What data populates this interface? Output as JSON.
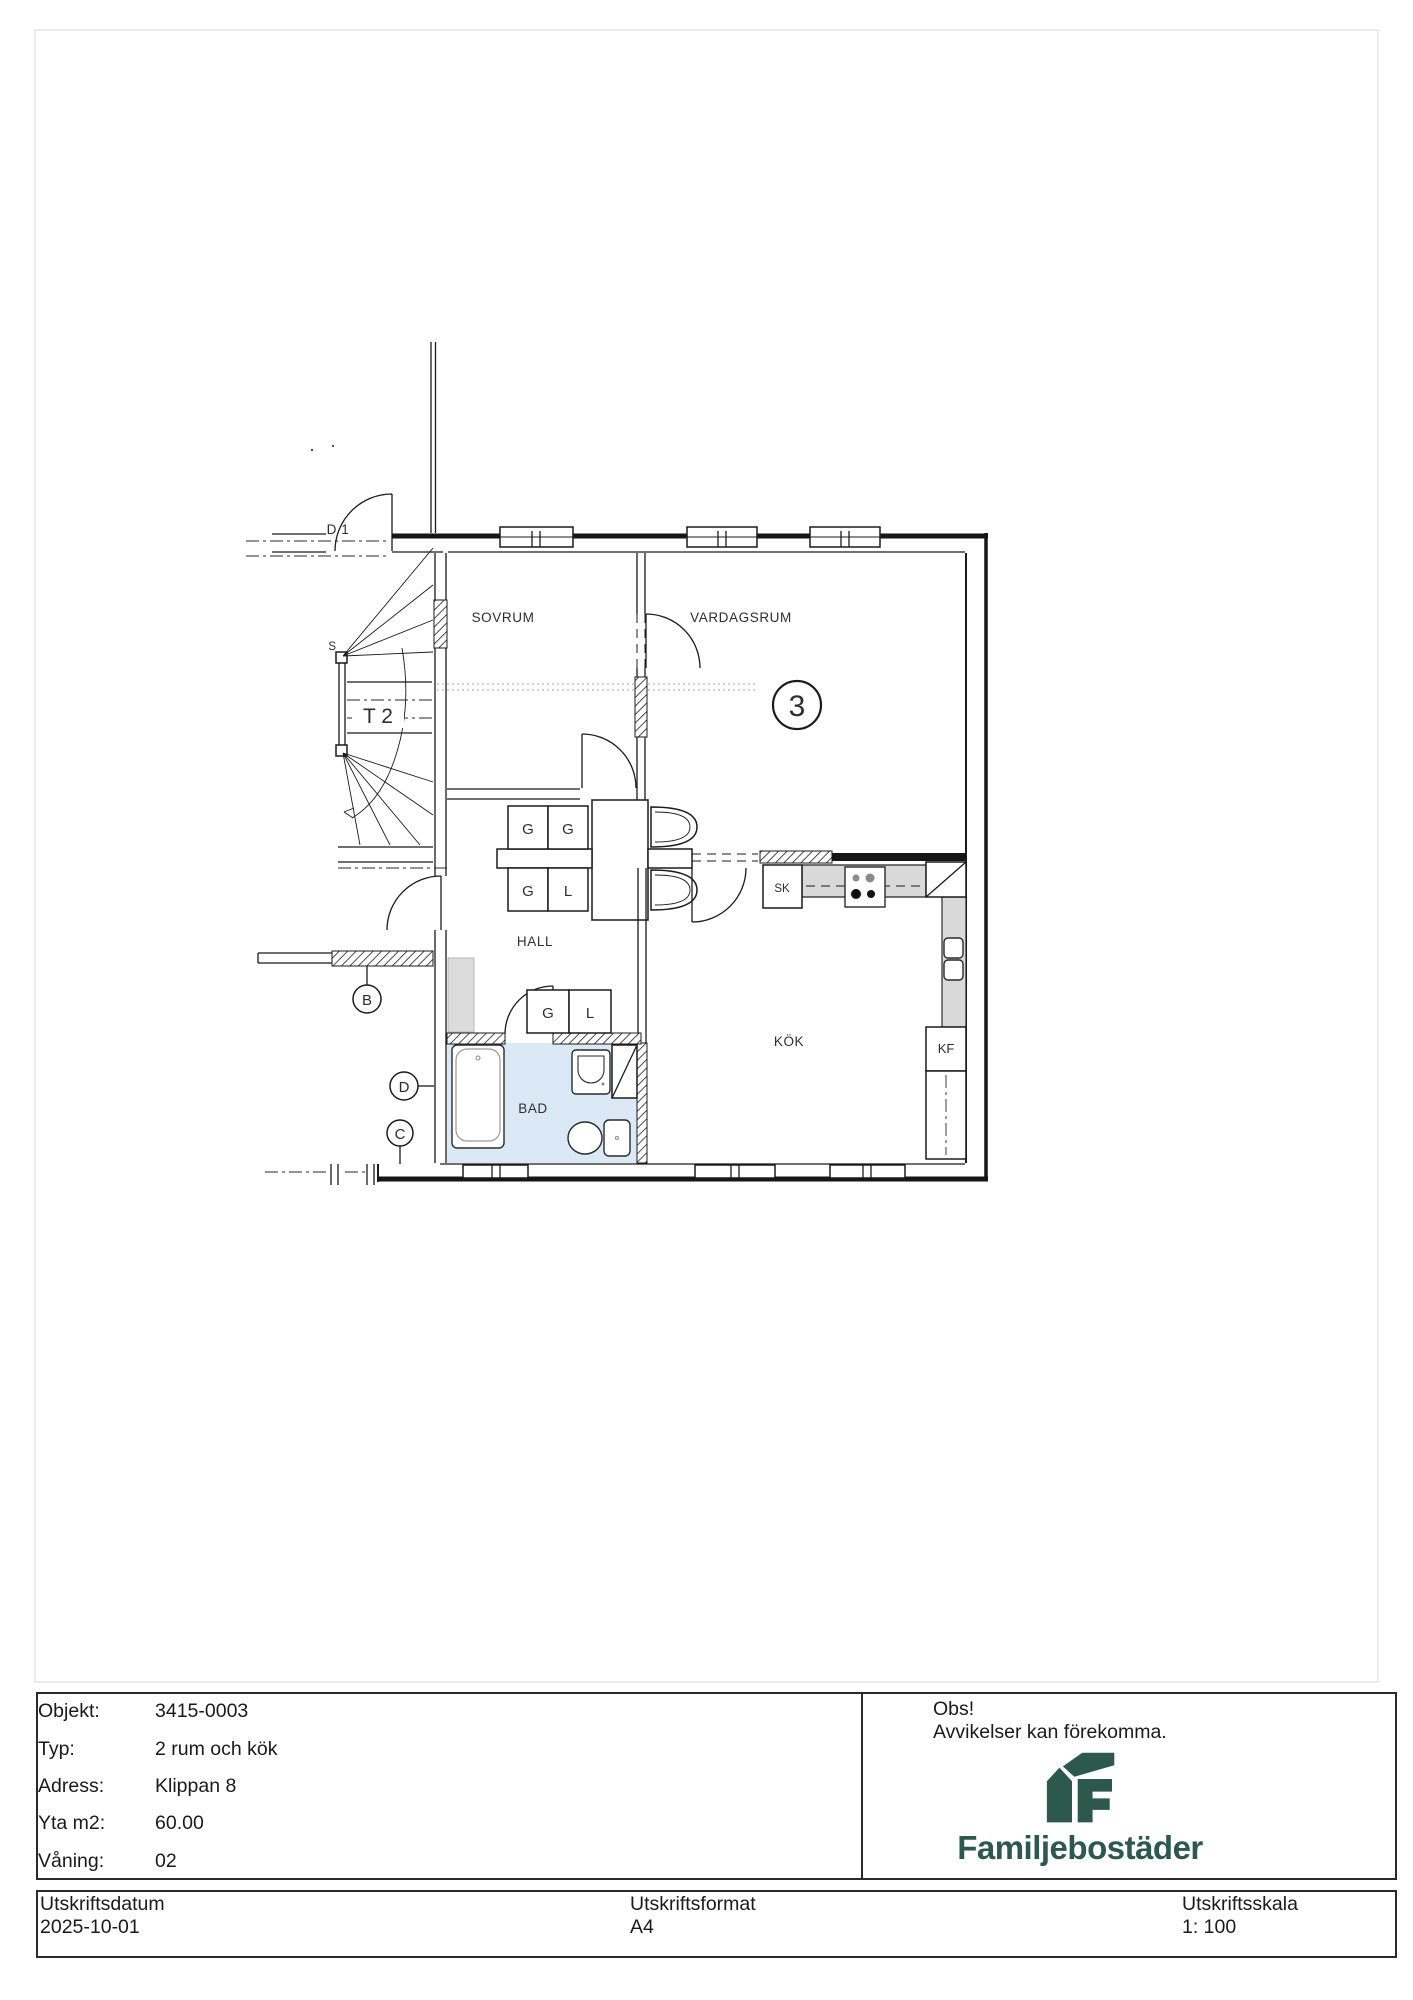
{
  "plan": {
    "labels": {
      "sovrum": "SOVRUM",
      "vardagsrum": "VARDAGSRUM",
      "hall": "HALL",
      "bad": "BAD",
      "kok": "KÖK",
      "apartment_number": "3",
      "stair": "T 2",
      "entrance_door": "D 1",
      "stair_s": "S",
      "cabinet_g": "G",
      "cabinet_l": "L",
      "cabinet_sk": "SK",
      "cabinet_kf": "KF",
      "section_b": "B",
      "section_c": "C",
      "section_d": "D"
    },
    "colors": {
      "bath_fill": "#dbe9f7",
      "counter_fill": "#d9d9d9",
      "line": "#1b1b1b"
    }
  },
  "info_table": {
    "rows": [
      {
        "label": "Objekt:",
        "value": "3415-0003"
      },
      {
        "label": "Typ:",
        "value": "2 rum och kök"
      },
      {
        "label": "Adress:",
        "value": "Klippan 8"
      },
      {
        "label": "Yta m2:",
        "value": "60.00"
      },
      {
        "label": "Våning:",
        "value": "02"
      }
    ],
    "notice": {
      "title": "Obs!",
      "body": "Avvikelser kan förekomma."
    },
    "brand": {
      "name": "Familjebostäder",
      "color": "#2d594d"
    }
  },
  "footer": {
    "cells": [
      {
        "label": "Utskriftsdatum",
        "value": "2025-10-01"
      },
      {
        "label": "Utskriftsformat",
        "value": "A4"
      },
      {
        "label": "Utskriftsskala",
        "value": "1: 100"
      }
    ]
  }
}
